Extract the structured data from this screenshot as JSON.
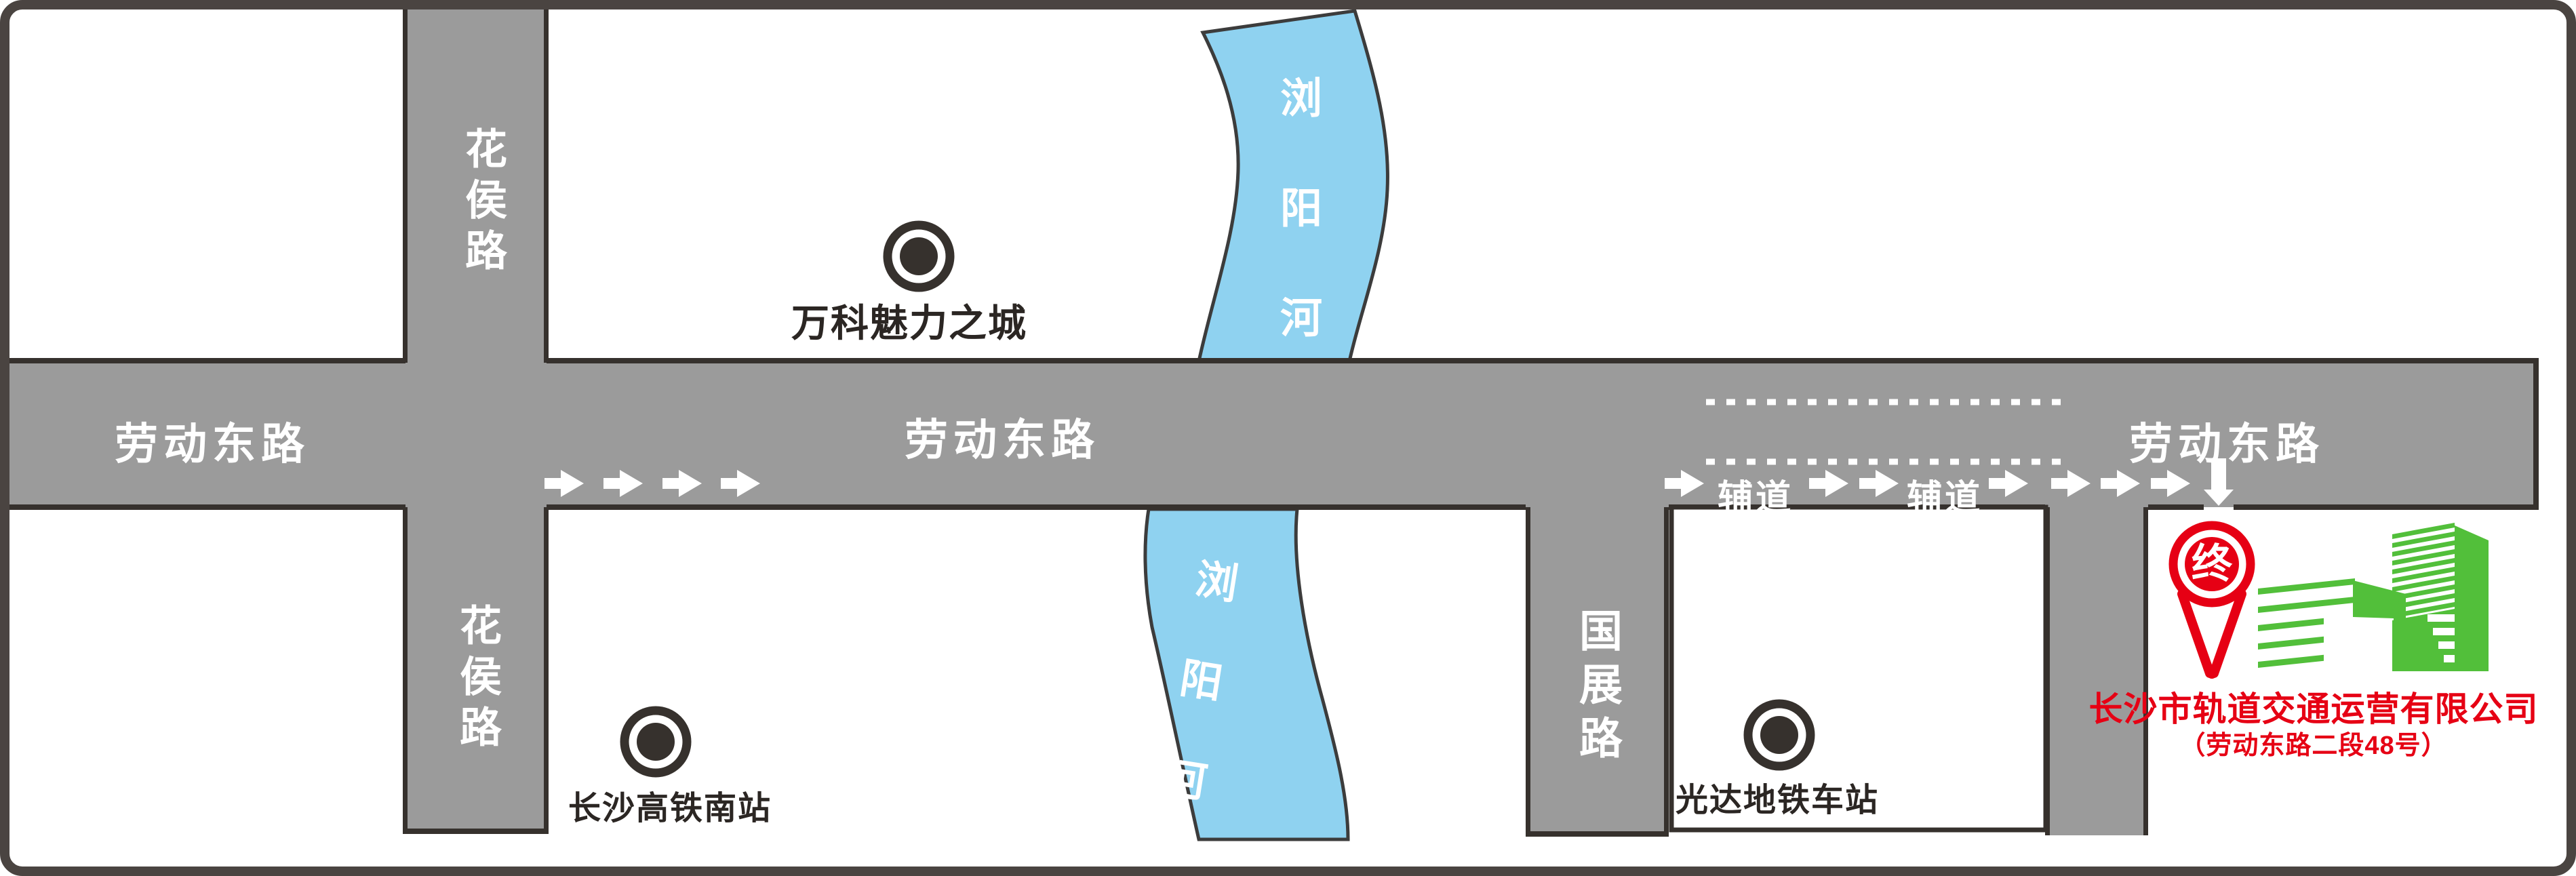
{
  "roads": {
    "laodong_left": "劳动东路",
    "laodong_mid": "劳动东路",
    "laodong_right": "劳动东路",
    "huahou_top": "花侯路",
    "huahou_bottom": "花侯路",
    "guozhan": "国展路"
  },
  "lanes": {
    "fudao_left": "辅道",
    "fudao_right": "辅道"
  },
  "river": {
    "top": "浏阳河",
    "bottom": "浏阳河"
  },
  "pois": {
    "vanke": "万科魅力之城",
    "rail_station": "长沙高铁南站",
    "metro_station": "光达地铁车站"
  },
  "destination": {
    "pin_char": "终",
    "company": "长沙市轨道交通运营有限公司",
    "address": "（劳动东路二段48号）"
  },
  "colors": {
    "road_gray": "#9b9b9b",
    "outline_dark": "#36312d",
    "river_blue": "#8fd2f0",
    "accent_red": "#e60014",
    "accent_green": "#52bf3a",
    "label_white": "#ffffff",
    "frame": "#4a4441"
  }
}
